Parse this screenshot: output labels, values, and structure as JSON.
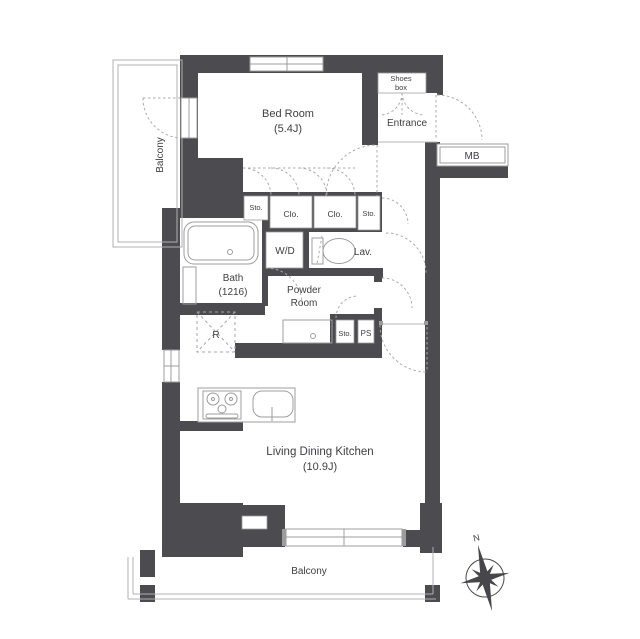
{
  "floorplan": {
    "rooms": {
      "balcony_left": "Balcony",
      "bedroom_name": "Bed Room",
      "bedroom_size": "(5.4J)",
      "shoes_line1": "Shoes",
      "shoes_line2": "box",
      "entrance": "Entrance",
      "mb": "MB",
      "sto_left": "Sto.",
      "clo_1": "Clo.",
      "clo_2": "Clo.",
      "sto_right": "Sto.",
      "wd": "W/D",
      "lav": "Lav.",
      "bath_name": "Bath",
      "bath_size": "(1216)",
      "powder_line1": "Powder",
      "powder_line2": "Room",
      "sto_powder": "Sto.",
      "ps": "PS",
      "fridge": "R",
      "ldk_name": "Living Dining Kitchen",
      "ldk_size": "(10.9J)",
      "balcony_bottom": "Balcony"
    },
    "compass": {
      "north": "N"
    },
    "colors": {
      "wall": "#4b4b50",
      "fixture_line": "#9c9c9c",
      "door_arc": "#ababab",
      "text": "#3f3f42"
    }
  }
}
